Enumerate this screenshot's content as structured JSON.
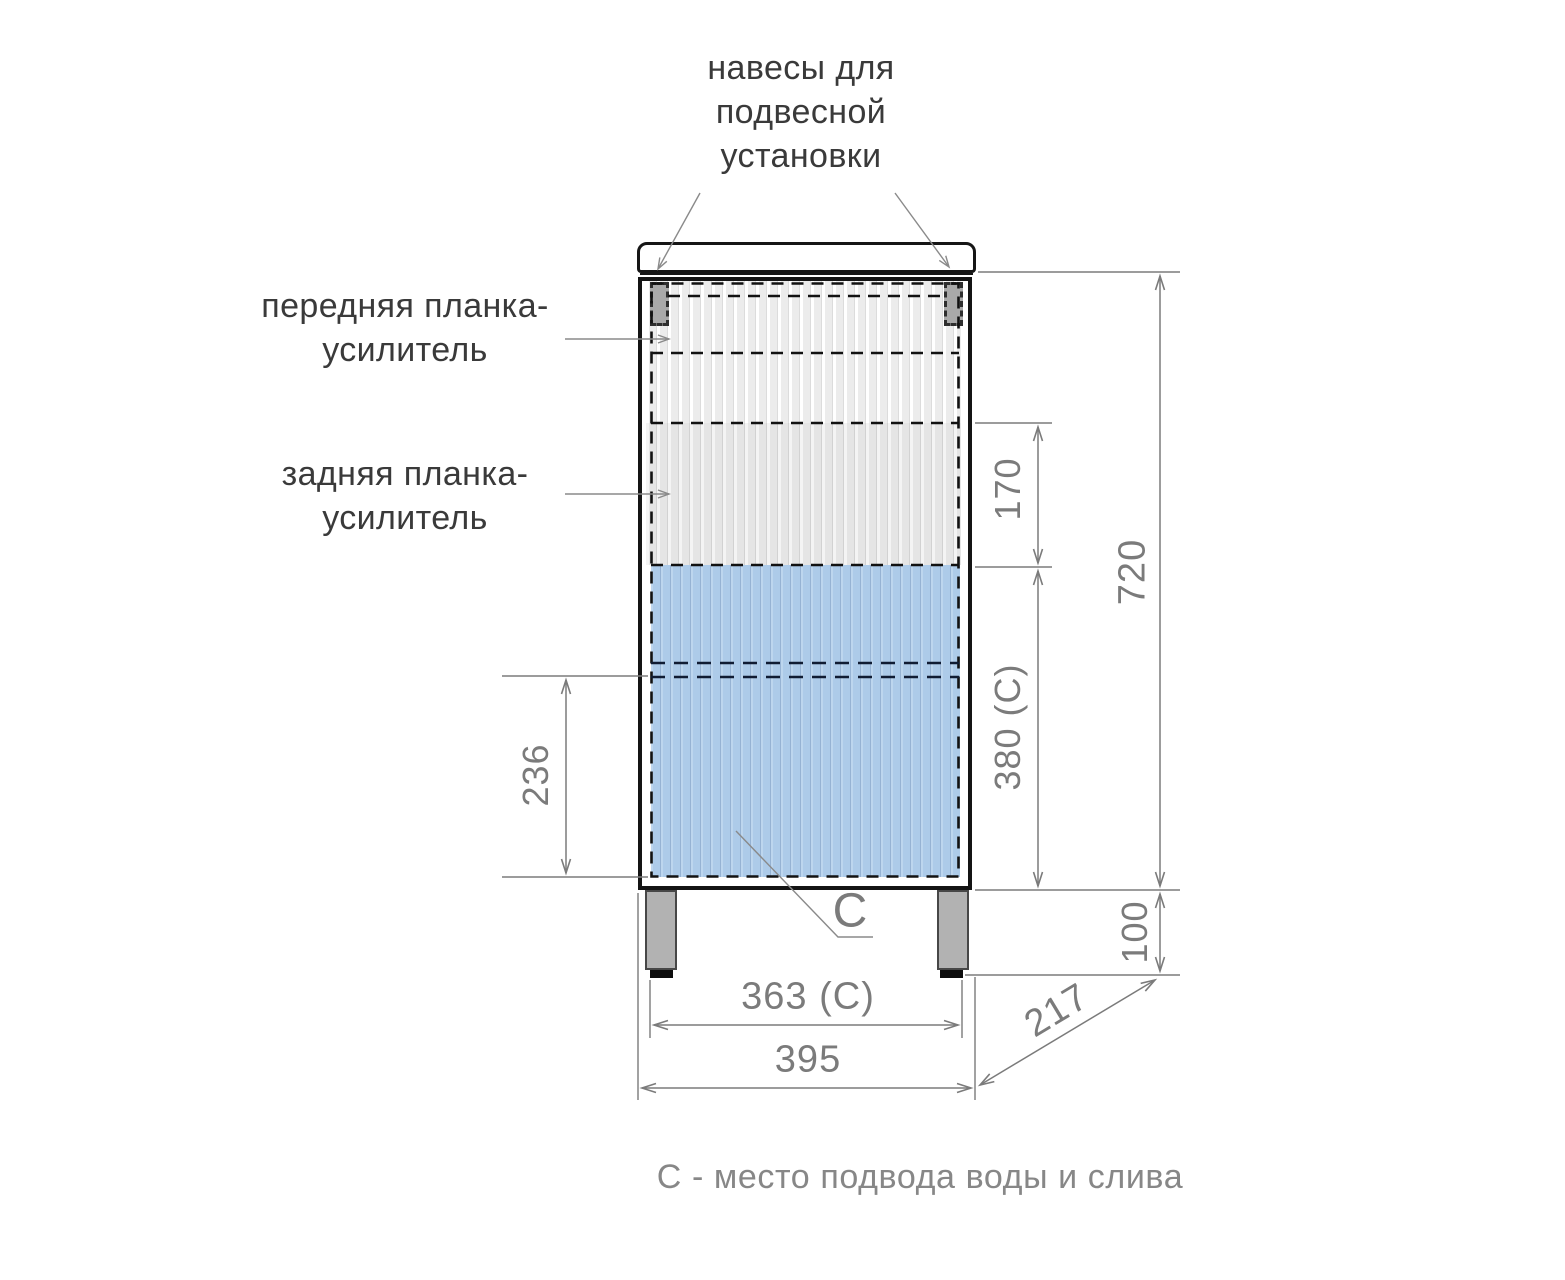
{
  "annotations": {
    "hangers": "навесы для\nподвесной\nустановки",
    "front_bar": "передняя планка-\nусилитель",
    "rear_bar": "задняя планка-\nусилитель",
    "c_marker": "С",
    "caption": "С - место подвода воды и слива"
  },
  "dimensions": {
    "body_height": "720",
    "rear_bar_offset": "170",
    "c_zone_height": "380 (С)",
    "shelf_to_bottom": "236",
    "leg_height": "100",
    "overall_width": "395",
    "feet_span": "363 (С)",
    "depth": "217"
  },
  "colors": {
    "outline": "#141414",
    "dimension_gray": "#7b7b7b",
    "fill_blue": "#adcbe9",
    "fill_gray_stripe": "#ececec",
    "leg_gray": "#b2b2b2"
  }
}
